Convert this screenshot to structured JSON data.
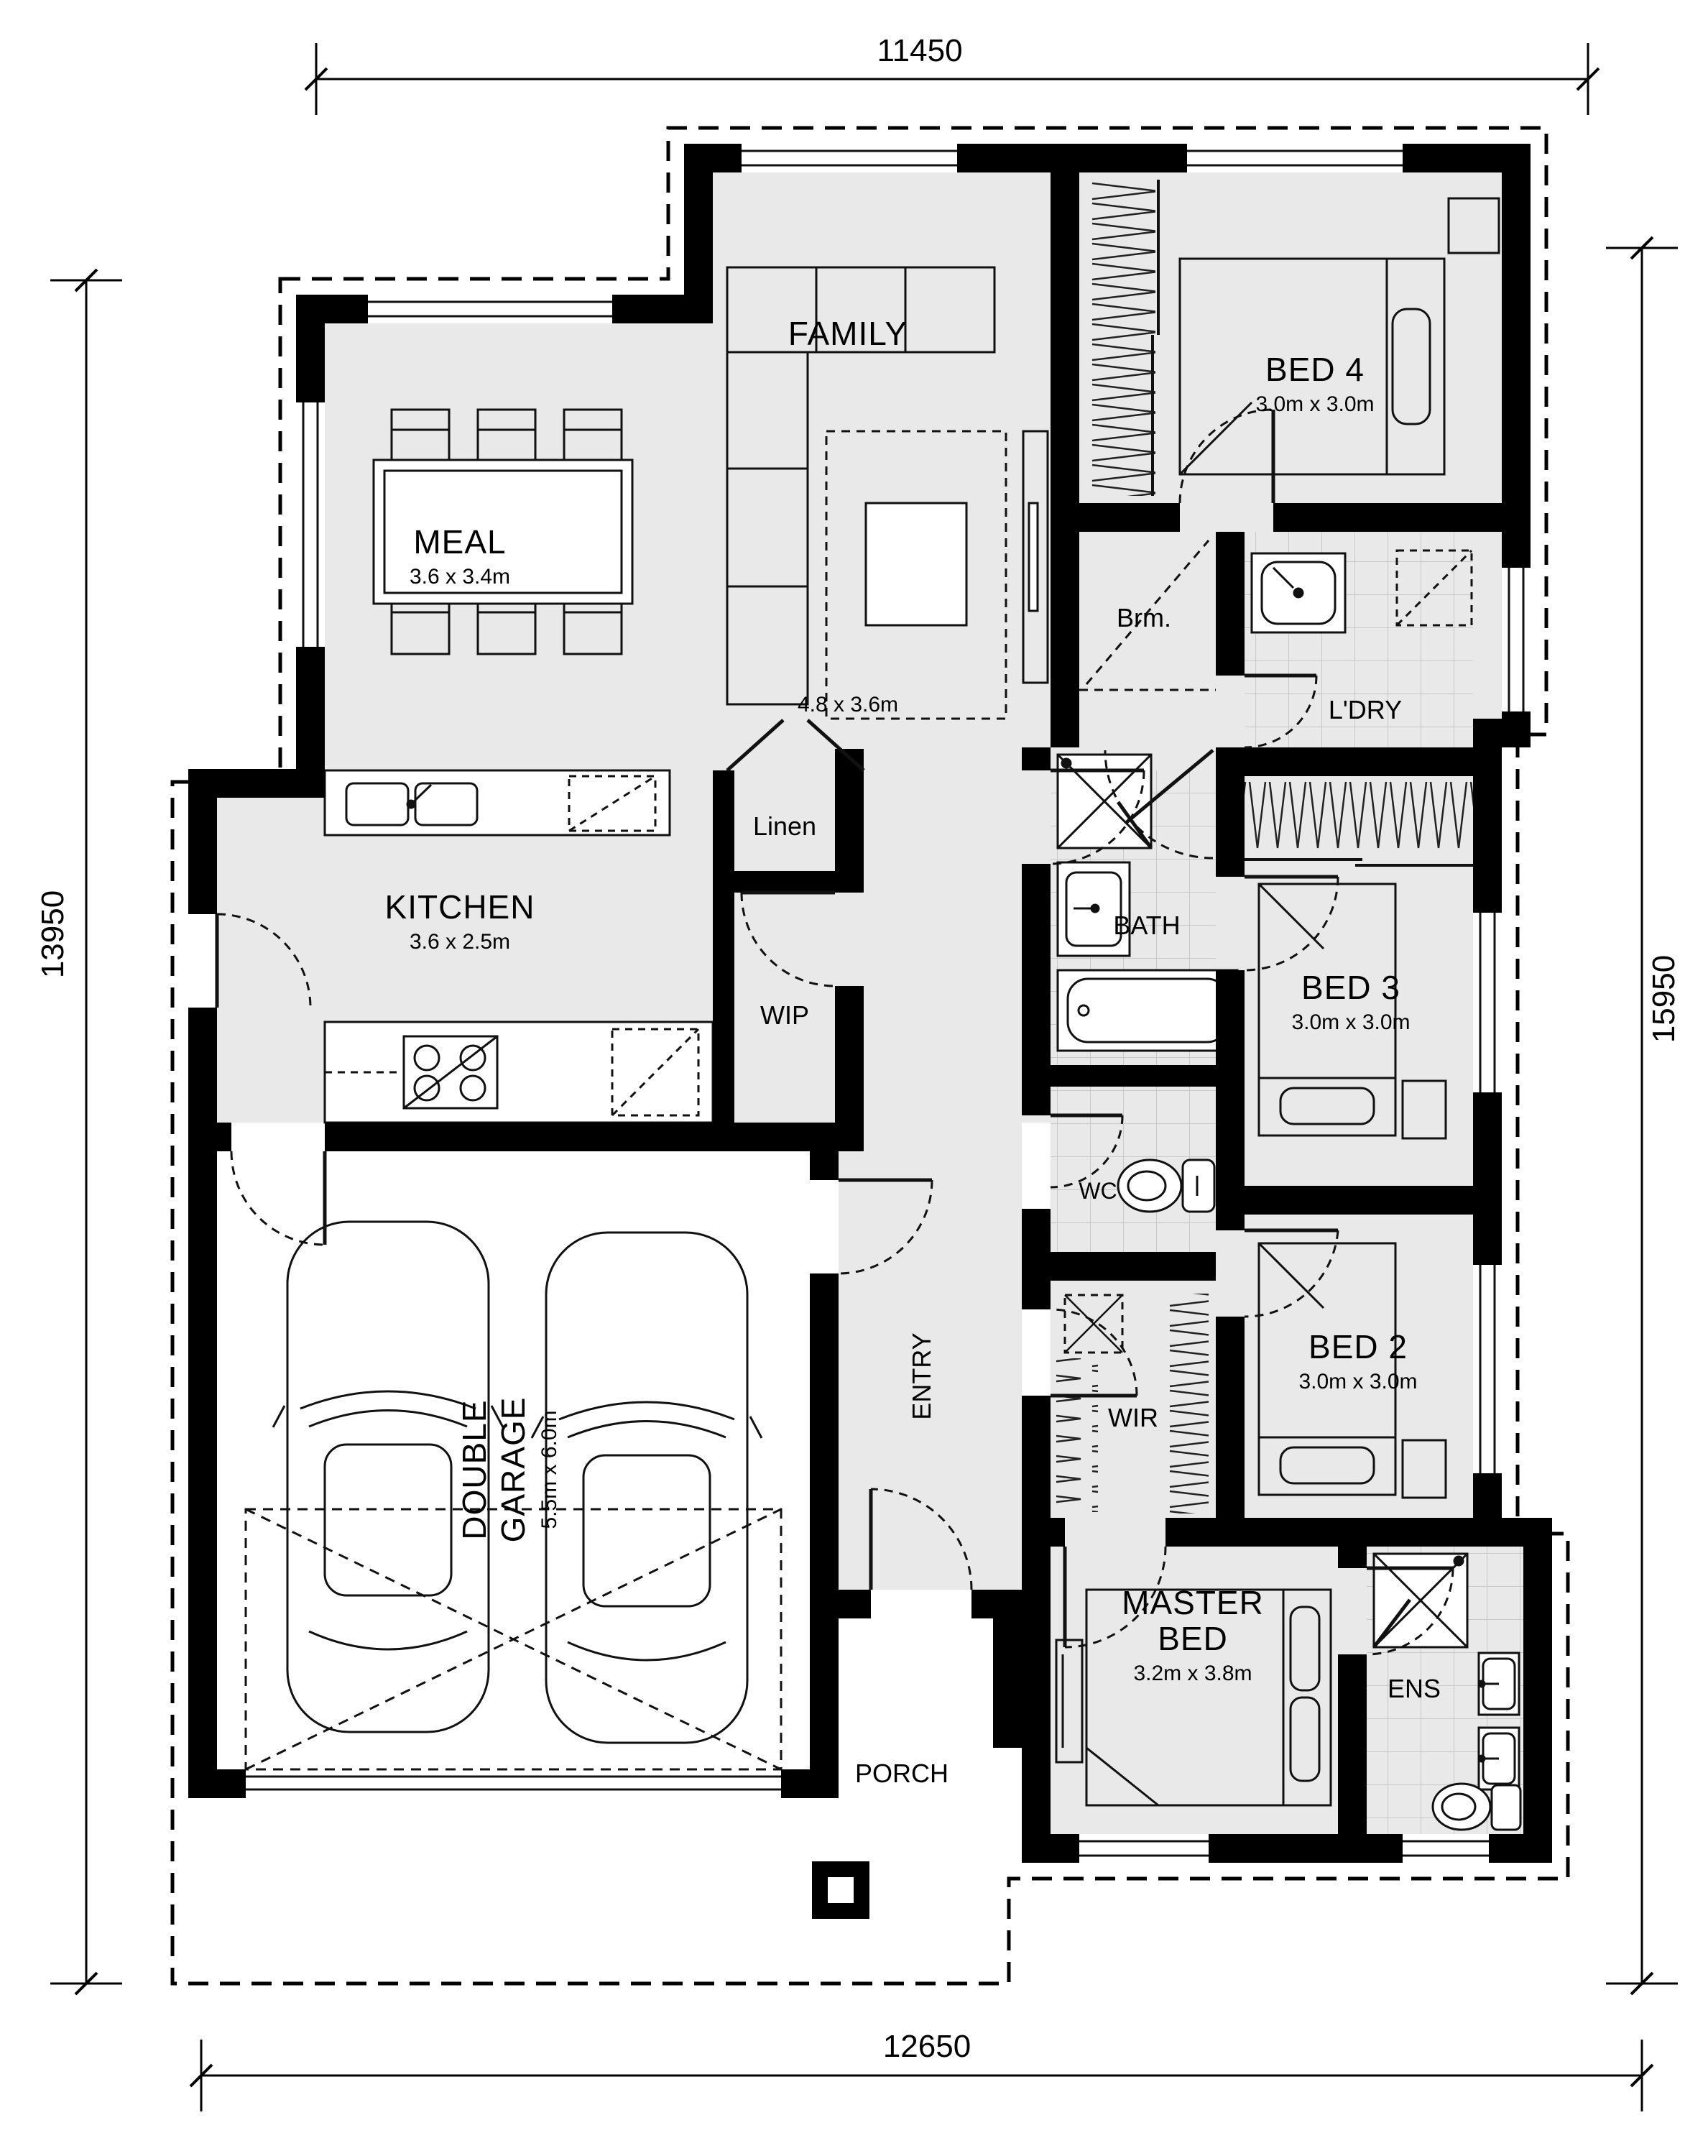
{
  "dimensions": {
    "top": "11450",
    "left": "13950",
    "right": "15950",
    "bottom": "12650"
  },
  "rooms": {
    "family": {
      "name": "FAMILY",
      "size": "4.8 x 3.6m"
    },
    "meal": {
      "name": "MEAL",
      "size": "3.6 x 3.4m"
    },
    "kitchen": {
      "name": "KITCHEN",
      "size": "3.6 x 2.5m"
    },
    "bed4": {
      "name": "BED 4",
      "size": "3.0m x 3.0m"
    },
    "bed3": {
      "name": "BED 3",
      "size": "3.0m x 3.0m"
    },
    "bed2": {
      "name": "BED 2",
      "size": "3.0m x 3.0m"
    },
    "master": {
      "name": "MASTER",
      "name2": "BED",
      "size": "3.2m x 3.8m"
    },
    "garage": {
      "name": "DOUBLE",
      "name2": "GARAGE",
      "size": "5.5m x 6.0m"
    },
    "bath": {
      "name": "BATH"
    },
    "wc": {
      "name": "WC"
    },
    "ens": {
      "name": "ENS"
    },
    "wir": {
      "name": "WIR"
    },
    "wip": {
      "name": "WIP"
    },
    "linen": {
      "name": "Linen"
    },
    "ldry": {
      "name": "L'DRY"
    },
    "brm": {
      "name": "Brm."
    },
    "entry": {
      "name": "ENTRY"
    },
    "porch": {
      "name": "PORCH"
    }
  }
}
